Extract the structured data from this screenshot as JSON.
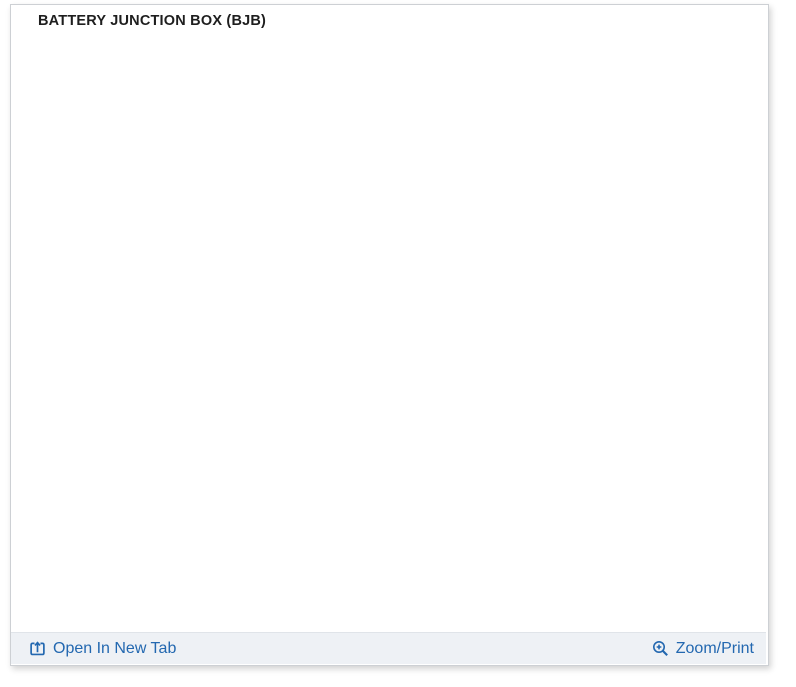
{
  "header": {
    "title": "BATTERY JUNCTION BOX (BJB)"
  },
  "footer": {
    "open_link": {
      "label": "Open In New Tab",
      "icon": "open-in-new-tab"
    },
    "zoom_link": {
      "label": "Zoom/Print",
      "icon": "magnifier-plus"
    }
  },
  "colors": {
    "link_blue": "#2368b0",
    "diagram_stroke": "#4a4a4a",
    "footer_bg": "#eef1f5",
    "panel_border": "#cdd0d4"
  },
  "diagram": {
    "name": "Battery Junction Box fuse layout",
    "fuses": [
      {
        "id": "F56",
        "x": 226,
        "y": 123,
        "w": 36,
        "h": 20,
        "thick": false
      },
      {
        "id": "F57",
        "x": 512,
        "y": 122,
        "w": 37,
        "h": 20,
        "thick": false
      },
      {
        "id": "F58",
        "x": 567,
        "y": 144,
        "w": 28,
        "h": 35,
        "thick": false
      },
      {
        "id": "F59",
        "x": 217,
        "y": 170,
        "w": 26,
        "h": 33,
        "thick": false
      },
      {
        "id": "F60",
        "x": 268,
        "y": 180,
        "w": 27,
        "h": 37,
        "thick": false
      },
      {
        "id": "F61",
        "x": 687,
        "y": 184,
        "w": 26,
        "h": 34,
        "thick": false
      },
      {
        "id": "F62",
        "x": 62,
        "y": 233,
        "w": 40,
        "h": 34,
        "thick": false
      },
      {
        "id": "F63",
        "x": 116,
        "y": 225,
        "w": 27,
        "h": 35,
        "thick": false
      },
      {
        "id": "F64",
        "x": 553,
        "y": 225,
        "w": 28,
        "h": 34,
        "thick": false
      },
      {
        "id": "F65",
        "x": 623,
        "y": 239,
        "w": 28,
        "h": 33,
        "thick": false
      },
      {
        "id": "F66",
        "x": 662,
        "y": 238,
        "w": 28,
        "h": 34,
        "thick": false
      },
      {
        "id": "F67",
        "x": 165,
        "y": 277,
        "w": 39,
        "h": 35,
        "thick": true
      },
      {
        "id": "F68",
        "x": 224,
        "y": 279,
        "w": 27,
        "h": 32,
        "thick": false
      },
      {
        "id": "F69",
        "x": 63,
        "y": 318,
        "w": 35,
        "h": 24,
        "thick": false
      },
      {
        "id": "F70",
        "x": 63,
        "y": 357,
        "w": 35,
        "h": 22,
        "thick": false
      },
      {
        "id": "F71",
        "x": 517,
        "y": 352,
        "w": 39,
        "h": 33,
        "thick": true
      },
      {
        "id": "F72",
        "x": 574,
        "y": 358,
        "w": 34,
        "h": 22,
        "thick": false
      },
      {
        "id": "F73",
        "x": 679,
        "y": 356,
        "w": 34,
        "h": 22,
        "thick": false
      },
      {
        "id": "F74",
        "x": 64,
        "y": 394,
        "w": 33,
        "h": 22,
        "thick": false
      },
      {
        "id": "F75",
        "x": 526,
        "y": 407,
        "w": 33,
        "h": 21,
        "thick": false
      },
      {
        "id": "F76",
        "x": 574,
        "y": 394,
        "w": 34,
        "h": 23,
        "thick": false
      },
      {
        "id": "F77",
        "x": 677,
        "y": 396,
        "w": 35,
        "h": 21,
        "thick": false
      },
      {
        "id": "F78",
        "x": 65,
        "y": 429,
        "w": 33,
        "h": 22,
        "thick": false
      },
      {
        "id": "F79",
        "x": 318,
        "y": 413,
        "w": 25,
        "h": 34,
        "thick": false
      },
      {
        "id": "F80",
        "x": 572,
        "y": 428,
        "w": 37,
        "h": 23,
        "thick": false
      },
      {
        "id": "F81",
        "x": 678,
        "y": 430,
        "w": 34,
        "h": 21,
        "thick": false
      },
      {
        "id": "F82",
        "x": 186,
        "y": 460,
        "w": 41,
        "h": 36,
        "thick": false
      },
      {
        "id": "F83",
        "x": 241,
        "y": 463,
        "w": 27,
        "h": 35,
        "thick": false
      },
      {
        "id": "F84",
        "x": 358,
        "y": 443,
        "w": 27,
        "h": 37,
        "thick": false
      },
      {
        "id": "F85",
        "x": 678,
        "y": 466,
        "w": 34,
        "h": 21,
        "thick": false
      }
    ],
    "cavity_circles": [
      {
        "cx": 334,
        "cy": 180,
        "r": 17
      },
      {
        "cx": 518,
        "cy": 217,
        "r": 17
      },
      {
        "cx": 401,
        "cy": 272,
        "r": 16
      },
      {
        "cx": 528,
        "cy": 301,
        "r": 17
      },
      {
        "cx": 156,
        "cy": 326,
        "r": 17
      },
      {
        "cx": 306,
        "cy": 339,
        "r": 17
      },
      {
        "cx": 184,
        "cy": 421,
        "r": 15
      }
    ]
  }
}
